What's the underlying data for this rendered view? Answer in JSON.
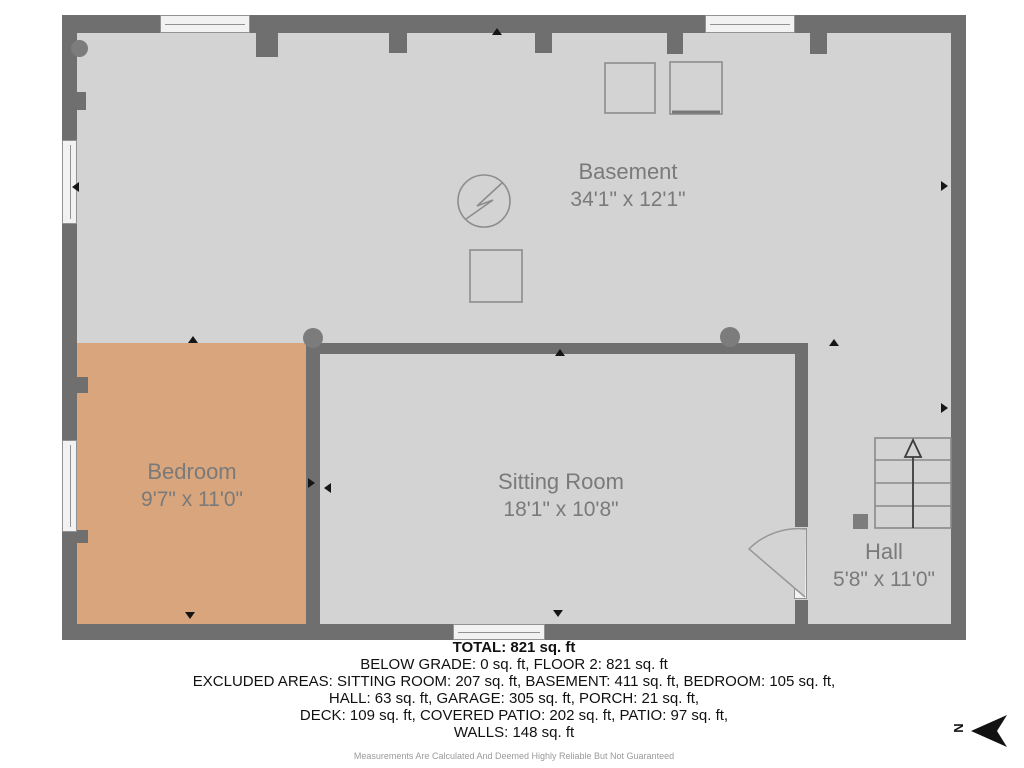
{
  "rooms": {
    "basement": {
      "name": "Basement",
      "dims": "34'1\" x 12'1\""
    },
    "bedroom": {
      "name": "Bedroom",
      "dims": "9'7\" x 11'0\""
    },
    "sitting_room": {
      "name": "Sitting Room",
      "dims": "18'1\" x 10'8\""
    },
    "hall": {
      "name": "Hall",
      "dims": "5'8\" x 11'0\""
    }
  },
  "summary": {
    "total": "TOTAL: 821 sq. ft",
    "lines": [
      "BELOW GRADE: 0 sq. ft, FLOOR 2: 821 sq. ft",
      "EXCLUDED AREAS: SITTING ROOM: 207 sq. ft, BASEMENT: 411 sq. ft, BEDROOM: 105 sq. ft,",
      "HALL: 63 sq. ft, GARAGE: 305 sq. ft, PORCH: 21 sq. ft,",
      "DECK: 109 sq. ft, COVERED PATIO: 202 sq. ft, PATIO: 97 sq. ft,",
      "WALLS: 148 sq. ft"
    ],
    "disclaimer": "Measurements Are Calculated And Deemed Highly Reliable But Not Guaranteed"
  },
  "compass": {
    "label": "N"
  },
  "colors": {
    "wall": "#6f6f6f",
    "floor": "#d3d3d3",
    "bedroom_floor": "#d9a57c",
    "room_label_text": "#7a7a7a"
  }
}
